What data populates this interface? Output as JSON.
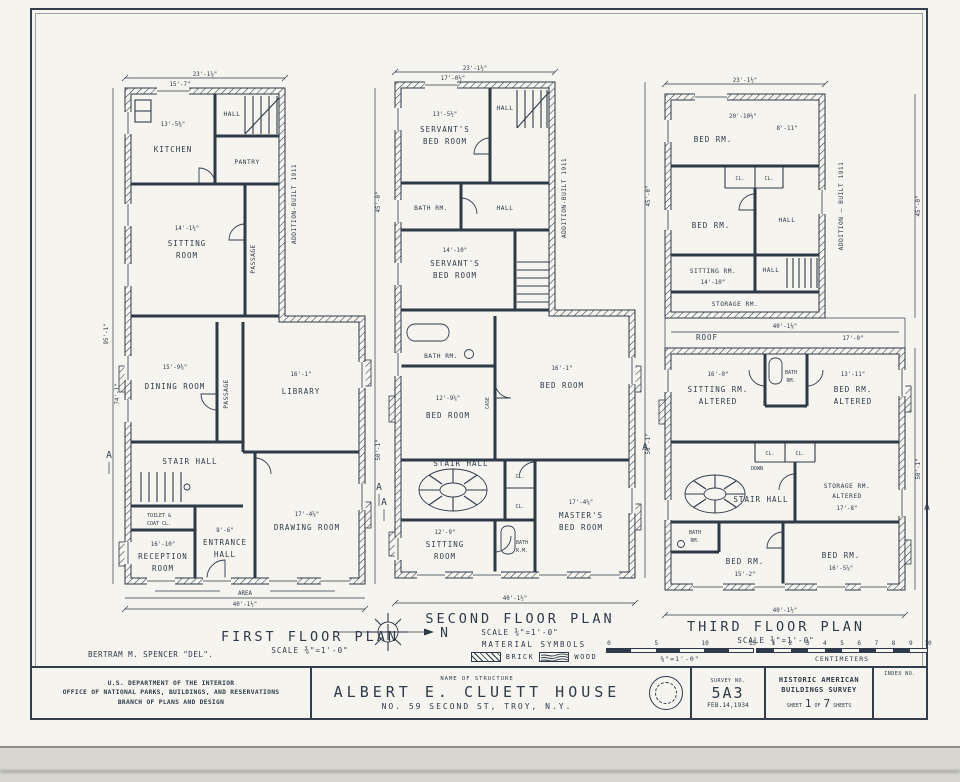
{
  "colors": {
    "ink": "#2f3a49",
    "paper": "#f5f4ef"
  },
  "sheet": {
    "delineator": "BERTRAM M. SPENCER \"DEL\".",
    "section_marker": "A",
    "north_label": "N",
    "area_label": "AREA"
  },
  "plan1": {
    "title": "FIRST FLOOR PLAN",
    "scale": "SCALE ⅜\"=1'-0\"",
    "addition_note": "ADDITION-BUILT 1911",
    "dim_top": "23'-1⅞\"",
    "dim_top_sub": "15'-7\"",
    "dim_bottom": "40'-1½\"",
    "dim_right_upper": "45'-0\"",
    "dim_right_lower": "50'-1\"",
    "dim_left": "95'-1\"",
    "dim_left_sub": "74'-1\"",
    "rooms": {
      "kitchen": {
        "label": "KITCHEN",
        "dim": "13'-5⅜\""
      },
      "hall": {
        "label": "HALL"
      },
      "pantry": {
        "label": "PANTRY"
      },
      "sitting": {
        "l1": "SITTING",
        "l2": "ROOM",
        "dim": "14'-1½\""
      },
      "passage1": {
        "label": "PASSAGE"
      },
      "dining": {
        "label": "DINING ROOM",
        "dim": "15'-9⅜\""
      },
      "passage2": {
        "label": "PASSAGE"
      },
      "library": {
        "label": "LIBRARY",
        "dim": "16'-1\""
      },
      "stair_hall": {
        "label": "STAIR HALL"
      },
      "toilet": {
        "l1": "TOILET &",
        "l2": "COAT CL."
      },
      "reception": {
        "l1": "RECEPTION",
        "l2": "ROOM",
        "dim": "16'-10\""
      },
      "entrance": {
        "l1": "ENTRANCE",
        "l2": "HALL",
        "dim": "8'-6\""
      },
      "drawing_room": {
        "label": "DRAWING ROOM",
        "dim": "17'-4⅝\""
      }
    }
  },
  "plan2": {
    "title": "SECOND FLOOR PLAN",
    "scale": "SCALE ⅜\"=1'-0\"",
    "addition_note": "ADDITION-BUILT 1911",
    "dim_top": "23'-1½\"",
    "dim_top_sub": "17'-0½\"",
    "dim_bottom": "40'-1½\"",
    "dim_right_upper": "45'-0\"",
    "dim_right_lower": "50'-1\"",
    "rooms": {
      "servants1": {
        "l1": "SERVANT'S",
        "l2": "BED ROOM",
        "dim": "13'-5½\""
      },
      "hall1": {
        "label": "HALL"
      },
      "bath1": {
        "label": "BATH RM."
      },
      "hall2": {
        "label": "HALL"
      },
      "servants2": {
        "l1": "SERVANT'S",
        "l2": "BED ROOM",
        "dim": "14'-10\""
      },
      "bath2": {
        "label": "BATH RM."
      },
      "bed1": {
        "label": "BED ROOM",
        "dim": "12'-9⅝\""
      },
      "bed2": {
        "label": "BED ROOM",
        "dim": "16'-1\""
      },
      "case": {
        "label": "CASE"
      },
      "cl_a": {
        "label": "CL."
      },
      "cl_b": {
        "label": "CL."
      },
      "stair_hall": {
        "label": "STAIR HALL"
      },
      "sitting": {
        "l1": "SITTING",
        "l2": "ROOM",
        "dim": "12'-9\""
      },
      "bath3": {
        "l1": "BATH",
        "l2": "R.M."
      },
      "masters": {
        "l1": "MASTER'S",
        "l2": "BED ROOM",
        "dim": "17'-4⅝\""
      }
    }
  },
  "plan3": {
    "title": "THIRD FLOOR PLAN",
    "scale": "SCALE ⅜\"=1'-0\"",
    "addition_note": "ADDITION — BUILT 1911",
    "dim_top": "23'-1½\"",
    "dim_bottom": "40'-1½\"",
    "dim_right_upper": "45'-0\"",
    "dim_right_lower": "50'-1\"",
    "roof_label": "ROOF",
    "roof_dim": "40'-1⅛\"",
    "roof_dim2": "17'-0\"",
    "rooms": {
      "bed_top": {
        "label": "BED RM.",
        "dim": "20'-10½\"",
        "dim2": "8'-11\""
      },
      "cl_a": {
        "label": "CL."
      },
      "cl_b": {
        "label": "CL."
      },
      "bed2": {
        "label": "BED RM."
      },
      "hall1": {
        "label": "HALL"
      },
      "sitting1": {
        "label": "SITTING RM.",
        "dim": "14'-10\""
      },
      "hall2": {
        "label": "HALL"
      },
      "storage1": {
        "label": "STORAGE RM."
      },
      "sitting2": {
        "l1": "SITTING RM.",
        "l2": "ALTERED",
        "dim": "16'-0\""
      },
      "bath1": {
        "l1": "BATH",
        "l2": "RM."
      },
      "bed_alt": {
        "l1": "BED RM.",
        "l2": "ALTERED",
        "dim": "13'-11\""
      },
      "cl_c": {
        "label": "CL."
      },
      "cl_d": {
        "label": "CL."
      },
      "stair_hall": {
        "label": "STAIR HALL",
        "down": "DOWN"
      },
      "storage2": {
        "l1": "STORAGE RM.",
        "l2": "ALTERED",
        "dim": "17'-8\""
      },
      "bath2": {
        "l1": "BATH",
        "l2": "RM."
      },
      "bed_b1": {
        "label": "BED RM.",
        "dim": "15'-2\""
      },
      "bed_b2": {
        "label": "BED RM.",
        "dim": "16'-5⅝\""
      }
    }
  },
  "legend": {
    "heading": "MATERIAL SYMBOLS",
    "brick": "BRICK",
    "wood": "WOOD"
  },
  "scalebar_ft": {
    "ticks": [
      "0",
      "5",
      "10",
      "15"
    ],
    "label": "⅜\"=1'-0\""
  },
  "scalebar_cm": {
    "ticks": [
      "1",
      "2",
      "3",
      "4",
      "5",
      "6",
      "7",
      "8",
      "9",
      "10"
    ],
    "label": "CENTIMETERS"
  },
  "titleblock": {
    "dept1": "U.S. DEPARTMENT OF THE INTERIOR",
    "dept2": "OFFICE OF NATIONAL PARKS, BUILDINGS, AND RESERVATIONS",
    "dept3": "BRANCH OF PLANS AND DESIGN",
    "name_label": "NAME OF STRUCTURE",
    "structure_name": "ALBERT E. CLUETT HOUSE",
    "structure_addr": "NO. 59 SECOND ST, TROY, N.Y.",
    "survey_label": "SURVEY NO.",
    "survey_no": "5A3",
    "survey_date": "FEB.14,1934",
    "habs1": "HISTORIC AMERICAN",
    "habs2": "BUILDINGS SURVEY",
    "sheet_label": "SHEET",
    "sheet_no": "1",
    "of_label": "OF",
    "sheets_total": "7",
    "sheets_label": "SHEETS",
    "index_label": "INDEX NO."
  }
}
